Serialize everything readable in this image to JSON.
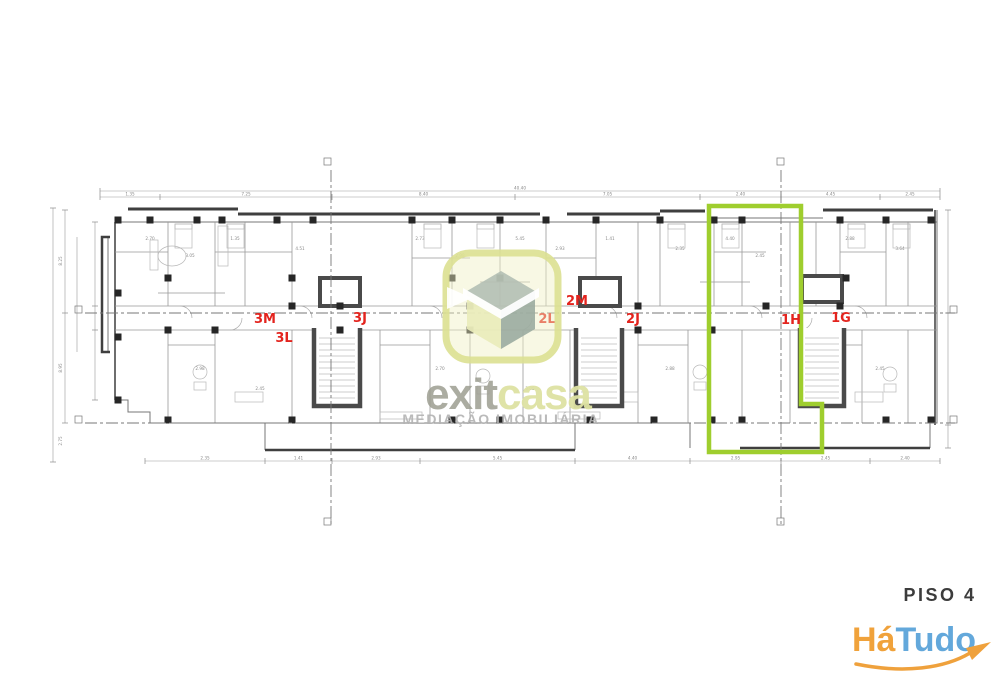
{
  "image": {
    "background": "#ffffff"
  },
  "plan": {
    "unit_labels": [
      "3M",
      "3L",
      "3J",
      "2M",
      "2L",
      "2J",
      "1H",
      "1G"
    ],
    "unit_label_color": "#E3241E",
    "highlight_color": "#9FCE2E",
    "wall_dark": "#3f3f3f",
    "wall_light": "#8a8a8a",
    "dims": {
      "top_overall": "40.40",
      "top": [
        "1.35",
        "7.25",
        "8.40",
        "7.05",
        "2.40",
        "4.45",
        "2.45"
      ],
      "bottom": [
        "2.35",
        "1.41",
        "2.93",
        "5.45",
        "4.40",
        "2.95",
        "2.45",
        "2.40"
      ],
      "left": [
        "8.25",
        "8.95",
        "2.75"
      ],
      "room": [
        "2.70",
        "3.05",
        "1.35",
        "4.51",
        "2.73",
        "2.98",
        "5.45",
        "2.93",
        "1.41",
        "2.35",
        "4.40",
        "2.45",
        "2.88",
        "3.64",
        "2.98",
        "2.45",
        "2.70",
        "3.05",
        "2.88",
        "2.45"
      ]
    }
  },
  "watermark": {
    "brand_part1": "exit",
    "brand_part2": "casa",
    "tagline": "MEDIAÇÃO IMOBILIÁRIA",
    "colors": {
      "square": "#DCE091",
      "part1": "#9C9D90",
      "part2": "#DDE2A2",
      "tagline": "#B3B3B3"
    }
  },
  "footer": {
    "floor_label": "PISO 4",
    "floor_label_color": "#3C3C3C",
    "logo": {
      "part1": "Há",
      "part2": "Tudo",
      "part1_color": "#F0A23B",
      "part2_color": "#63A8DB",
      "swoosh_color": "#EFA13C"
    }
  }
}
